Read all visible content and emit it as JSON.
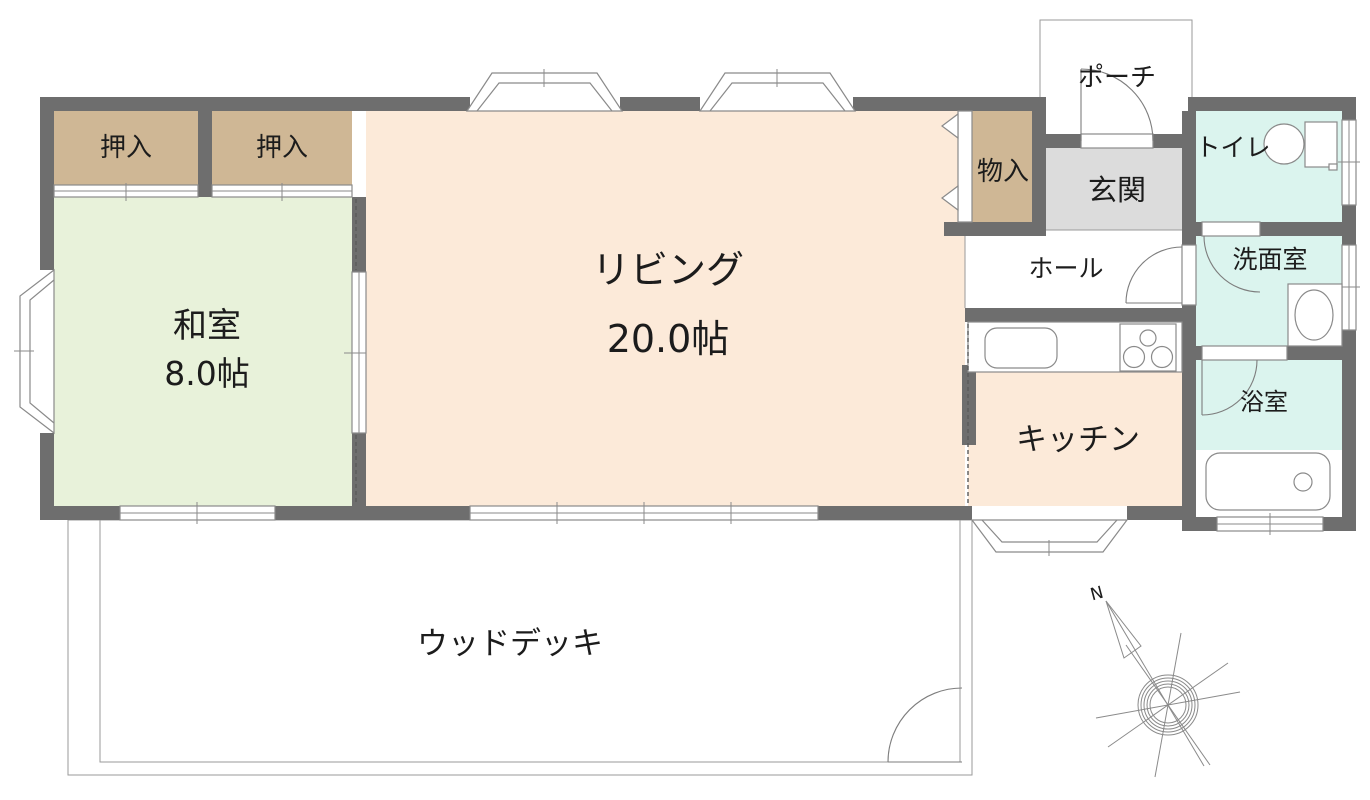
{
  "plan": {
    "type": "floor-plan",
    "rooms": {
      "oshiire_left": {
        "label": "押入"
      },
      "oshiire_right": {
        "label": "押入"
      },
      "washitsu": {
        "label": "和室",
        "size": "8.0帖"
      },
      "living": {
        "label": "リビング",
        "size": "20.0帖"
      },
      "monoire": {
        "label": "物入"
      },
      "porch": {
        "label": "ポーチ"
      },
      "genkan": {
        "label": "玄関"
      },
      "toilet": {
        "label": "トイレ"
      },
      "hall": {
        "label": "ホール"
      },
      "washroom": {
        "label": "洗面室"
      },
      "kitchen": {
        "label": "キッチン"
      },
      "bathroom": {
        "label": "浴室"
      },
      "wood_deck": {
        "label": "ウッドデッキ"
      }
    },
    "compass": {
      "north_label": "N"
    }
  },
  "colors": {
    "wall": "#6e6e6e",
    "closet": "#cfb795",
    "washitsu": "#e8f2da",
    "living": "#fcead9",
    "kitchen": "#fcead9",
    "porch": "#d4d4d4",
    "genkan": "#dcdcdc",
    "wet": "#dbf4ee",
    "white": "#ffffff"
  }
}
